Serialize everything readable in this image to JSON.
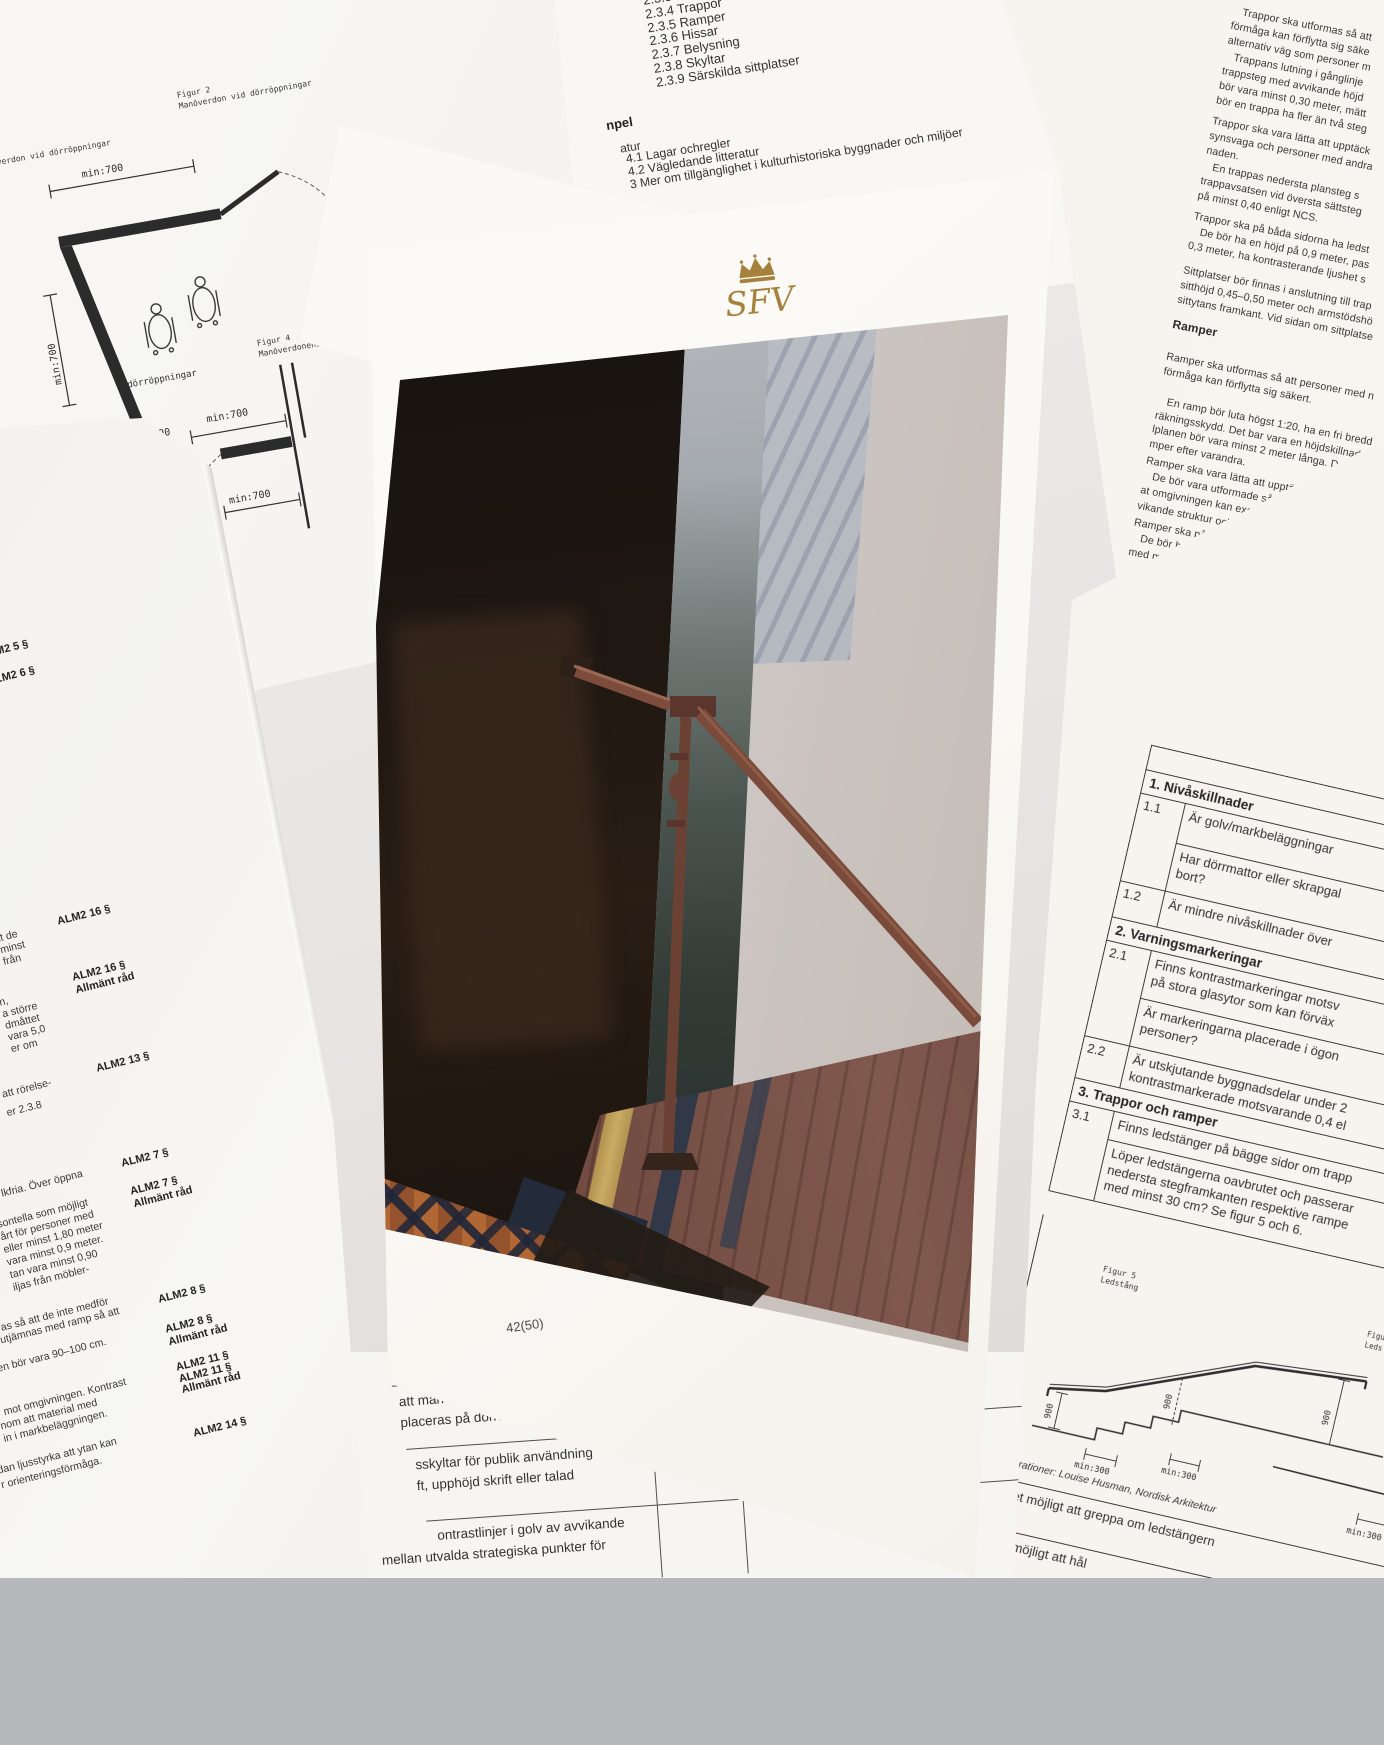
{
  "photo_page": {
    "logo_text": "SFV",
    "page_number": "42(50)"
  },
  "figure_paper": {
    "figur2_caption": "Figur 2\nManöverdon vid dörröppningar",
    "figur1_fragment": "verdon vid dörröppningar",
    "figur4_caption": "Figur 4\nManöverdonens pla",
    "door_caption": "dörröppningar",
    "dim_top_left": "min:700",
    "dim_side_left": "min:700",
    "dim_top_right": "min:700",
    "dim_bottom_right_a": "min:700",
    "dim_bottom_right_b": "min:700",
    "dim_800": ":800",
    "dim_door_a": "min:700",
    "dim_door_b": "min:700"
  },
  "toc_paper": {
    "items": "2.3.3\n2.3.4 Trappor\n2.3.5 Ramper\n2.3.6 Hissar\n2.3.7 Belysning\n2.3.8 Skyltar\n2.3.9 Särskilda sittplatser",
    "heading_fragment": "npel",
    "section_fragment": "atur",
    "lines": "4.1 Lagar ochregler\n4.2 Vägledande litteratur\n3 Mer om tillgänglighet i kulturhistoriska byggnader och miljöer"
  },
  "right_text_paper": {
    "para1": "   Trappor ska utformas så att\nförmåga kan förflytta sig säke\nalternativ väg som personer m\n   Trappans lutning i gånglinje\ntrappsteg med avvikande höjd\nbör vara minst 0,30 meter, mätt\nbör en trappa ha fler än två steg",
    "para2": "Trappor ska vara lätta att upptäck\nsynsvaga och personer med andra\nnaden.\n   En trappas nedersta plansteg s\ntrappavsatsen vid översta sättsteg\npå minst 0,40 enligt NCS.",
    "para3": "Trappor ska på båda sidorna ha ledst\n   De bör ha en höjd på 0,9 meter, pas\n0,3 meter, ha kontrasterande ljushet s",
    "para4": "Sittplatser bör finnas i anslutning till trap\nsitthöjd 0,45–0,50 meter och armstödshö\nsittytans framkant. Vid sidan om sittplatse",
    "heading": "Ramper",
    "para5": "Ramper ska utformas så att personer med n\nförmåga kan förflytta sig säkert.",
    "para6": "   En ramp bör luta högst 1:20, ha en fri bredd\nräkningsskydd. Det bar vara en höjdskillnad m\nlplanen bör vara minst 2 meter långa. Det kan\nmper efter varandra.",
    "para7": "Ramper ska vara lätta att upptäcka.\n   De bör vara utformade så att de tydligt framträ\nat omgivningen kan exempelvis åstadkommas g\nvikande struktur och ljushet fälls in i markbelägg",
    "para8": "Ramper ska på båda sidorna ha ledstänger som är\n   De bör ha en höjd på 0,9 meter och 0,7 meter, pa\nmed minst 0,3 meter, ha kontrasterande ljushet s"
  },
  "checklist_paper": {
    "col_header_fragment": "A",
    "section1": "1. Nivåskillnader",
    "row11_num": "1.1",
    "row11_q1": "Är golv/markbeläggningar",
    "row11_q2": "Har dörrmattor eller skrapgal\nbort?",
    "row12_num": "1.2",
    "row12_q": "Är mindre nivåskillnader över",
    "section2": "2. Varningsmarkeringar",
    "row21_num": "2.1",
    "row21_q1": "Finns kontrastmarkeringar motsv\npå stora glasytor som kan förväx",
    "row21_q2": "Är markeringarna placerade i ögon\npersoner?",
    "row22_num": "2.2",
    "row22_q": "Är utskjutande byggnadsdelar under 2\nkontrastmarkerade motsvarande 0,4 el",
    "section3": "3. Trappor och ramper",
    "row31_num": "3.1",
    "row31_q1": "Finns ledstänger på bägge sidor om trapp",
    "row31_q2": "Löper ledstängerna oavbrutet och passerar\nnedersta stegframkanten respektive rampe\nmed minst 30 cm? Se figur 5 och 6.",
    "figur5_caption": "Figur 5\nLedstång",
    "figur6_caption": "Figu\nLeds",
    "credit": "Illustrationer: Louise Husman, Nordisk Arkitektur",
    "rowA_q": "Är det möjligt att greppa om ledstängern",
    "rowB_q": "Är de möjligt att hål",
    "dims": {
      "d900a": "900",
      "d900b": "900",
      "d900c": "900",
      "min300a": "min:300",
      "min300b": "min:300",
      "min300c": "min:300"
    }
  },
  "bottom_table_paper": {
    "row1": "att man kan komma nå\nplaceras på dörrblad.",
    "row2": "sskyltar för publik användning\nft, upphöjd skrift eller talad",
    "row3": "ontrastlinjer i golv av avvikande",
    "row3b": "mellan utvalda strategiska punkter för"
  },
  "alm_paper": {
    "label_5": "M2 5 §",
    "label_6": "LM2 6 §",
    "label_16a": "ALM2 16 §",
    "body_16": "tt de\nminst\nfrån",
    "label_16b": "ALM2 16 §\nAllmänt råd",
    "body_13": "n,\na större\ndmåttet\nvara 5,0\ner om",
    "label_13": "ALM2 13 §",
    "body_13b": "att rörelse-\ner 2.3.8",
    "label_7a": "ALM2 7 §",
    "body_7": "lkfria. Över öppna",
    "label_7b": "ALM2 7 §\nAllmänt råd",
    "body_7b": "sontella som möjligt\nårt för personer med\neller minst 1,80 meter\nvara minst 0,9 meter.\ntan vara minst 0,90\niljas från möbler-",
    "label_8a": "ALM2 8 §",
    "body_8": "ras så att de inte medför\nutjämnas med ramp så att",
    "label_8b": "ALM2 8 §\nAllmänt råd",
    "body_11": "en bör vara 90–100 cm.",
    "label_11": "ALM2 11 §\nALM2 11 §\nAllmänt råd",
    "body_14": "r mot omgivningen. Kontrast\nnom att material med\nin i markbeläggningen.",
    "label_14": "ALM2 14 §",
    "body_15": "dan ljusstyrka att ytan kan\nr orienteringsförmåga."
  },
  "colors": {
    "logo_gold": "#a5813c",
    "handrail_brown": "#7a4a3a",
    "tile_terracotta": "#a35f34",
    "tile_navy": "#232a3a",
    "floor_stripe_yellow": "#c9ab64"
  }
}
